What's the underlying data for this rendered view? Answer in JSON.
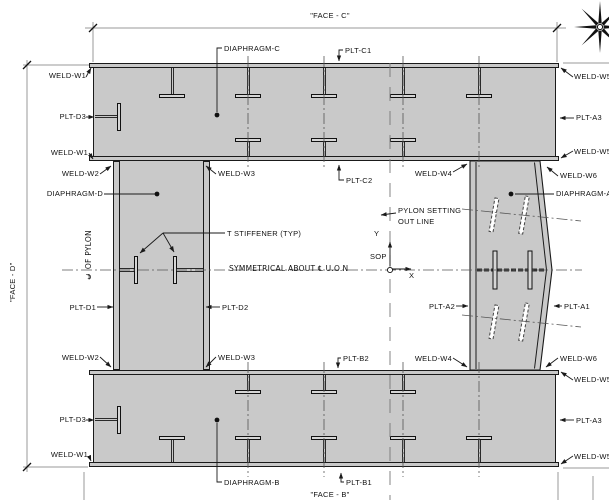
{
  "face_titles": {
    "top": "\"FACE - C\"",
    "left": "\"FACE - D\"",
    "bottom": "\"FACE - B\""
  },
  "labels": {
    "weld_w1": "WELD-W1",
    "weld_w2": "WELD-W2",
    "weld_w3": "WELD-W3",
    "weld_w4": "WELD-W4",
    "weld_w5": "WELD-W5",
    "weld_w6": "WELD-W6",
    "plt_a1": "PLT-A1",
    "plt_a2": "PLT-A2",
    "plt_a3": "PLT-A3",
    "plt_b1": "PLT-B1",
    "plt_b2": "PLT-B2",
    "plt_c1": "PLT-C1",
    "plt_c2": "PLT-C2",
    "plt_d1": "PLT-D1",
    "plt_d2": "PLT-D2",
    "plt_d3": "PLT-D3",
    "diaphragm_a": "DIAPHRAGM-A",
    "diaphragm_b": "DIAPHRAGM-B",
    "diaphragm_c": "DIAPHRAGM-C",
    "diaphragm_d": "DIAPHRAGM-D",
    "t_stiffener_typ": "T STIFFENER (TYP)",
    "symmetry_note": "SYMMETRICAL ABOUT ℄ U.O.N",
    "pylon_setting_l1": "PYLON SETTING",
    "pylon_setting_l2": "OUT LINE",
    "cl_of_pylon": "℄ OF PYLON",
    "sop": "SOP",
    "axis_x": "X",
    "axis_y": "Y"
  },
  "colors": {
    "steel_fill": "#c9c9c9",
    "line": "#1a1a1a",
    "dim_line": "#9a9a9a",
    "centerline": "#555555"
  }
}
